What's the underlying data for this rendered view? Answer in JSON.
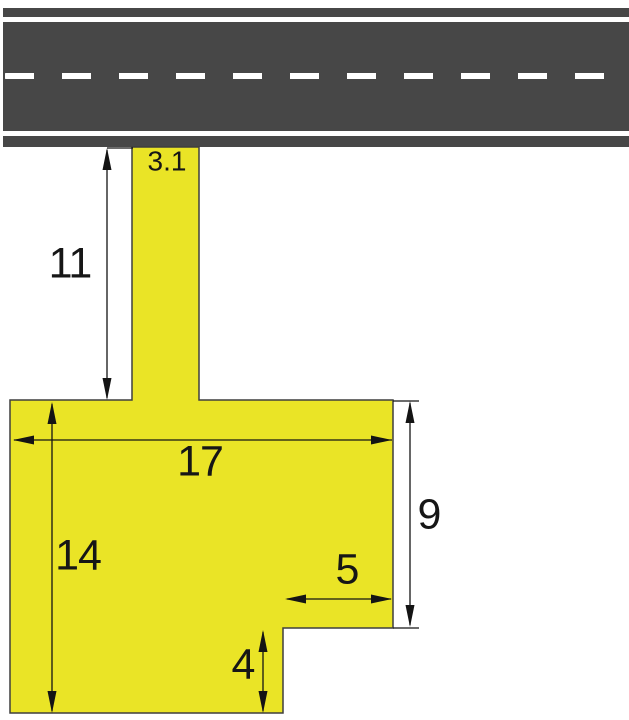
{
  "figure": {
    "description": "Geometry diagram of a yellow driveway connecting a road to an L-shaped paved lot, with dimension arrows",
    "road": {
      "surface_color": "#474747",
      "marking_color": "#ffffff"
    },
    "pavement": {
      "fill_color": "#eae426",
      "outline_color": "#3f3f3f"
    },
    "dimension_color": "#141414",
    "dimension_labels": {
      "driveway_width": "3.1",
      "driveway_length": "11",
      "lot_width": "17",
      "lot_left_height": "14",
      "lot_right_height": "9",
      "notch_width": "5",
      "notch_height": "4"
    }
  }
}
